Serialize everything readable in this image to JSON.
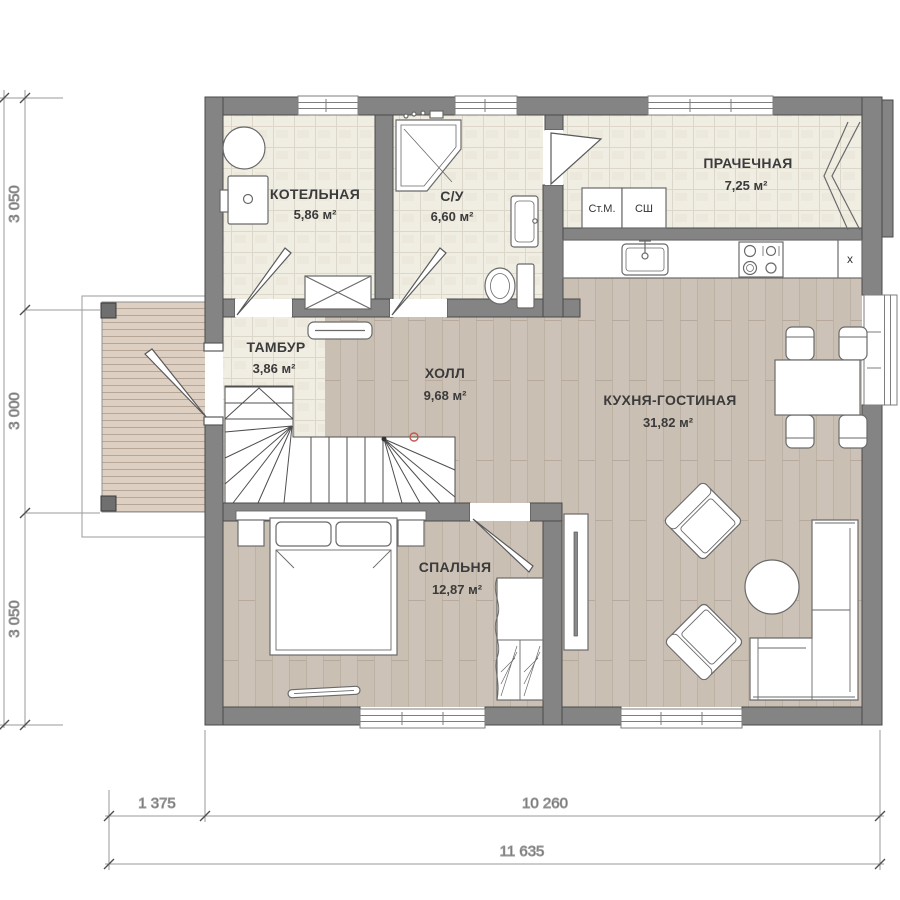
{
  "plan": {
    "title": "single-storey house floor plan",
    "rooms": [
      {
        "id": "boiler",
        "name": "КОТЕЛЬНАЯ",
        "area": "5,86 м²"
      },
      {
        "id": "wc",
        "name": "С/У",
        "area": "6,60 м²"
      },
      {
        "id": "laundry",
        "name": "ПРАЧЕЧНАЯ",
        "area": "7,25 м²"
      },
      {
        "id": "tambour",
        "name": "ТАМБУР",
        "area": "3,86 м²"
      },
      {
        "id": "hall",
        "name": "ХОЛЛ",
        "area": "9,68 м²"
      },
      {
        "id": "kitchen",
        "name": "КУХНЯ-ГОСТИНАЯ",
        "area": "31,82 м²"
      },
      {
        "id": "bedroom",
        "name": "СПАЛЬНЯ",
        "area": "12,87 м²"
      }
    ],
    "appliances": {
      "washer_label": "Ст.М.",
      "dryer_label": "СШ",
      "fridge_label": "x"
    },
    "dimensions": {
      "left": [
        "3 050",
        "3 000",
        "3 050"
      ],
      "bottom_segments": [
        "1 375",
        "10 260"
      ],
      "bottom_total": "11 635"
    },
    "colors": {
      "wall": "#848484",
      "tile_floor": "#f0ede3",
      "wood_floor": "#cdc2b7",
      "deck": "#ddd0c2",
      "outline": "#5a5a5a",
      "stair_marker_red": "#c4574b"
    }
  }
}
